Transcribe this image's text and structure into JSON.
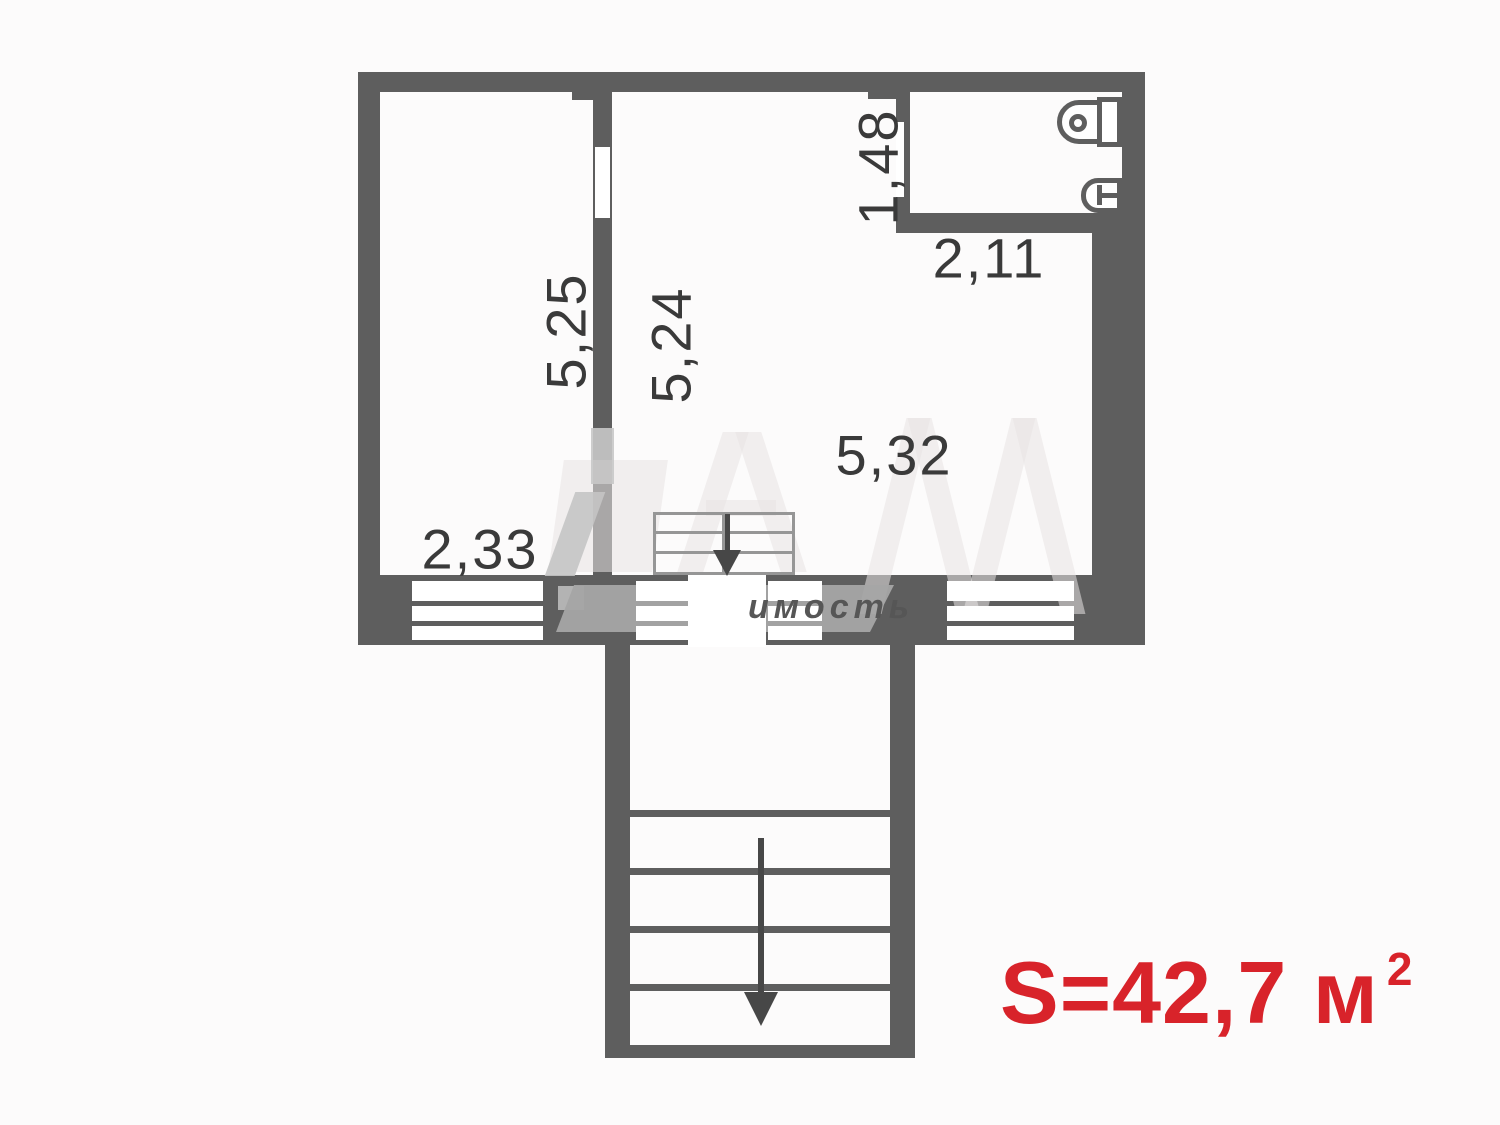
{
  "plan": {
    "dimensions": {
      "left_room_width": "2,33",
      "left_room_depth": "5,25",
      "main_room_depth": "5,24",
      "main_room_width": "5,32",
      "bathroom_width": "2,11",
      "bathroom_entry_height": "1,48"
    },
    "area_label": {
      "value": "S=42,7 м",
      "superscript": "2"
    },
    "watermark": {
      "visible_text": "имость"
    },
    "colors": {
      "wall": "#5e5e5e",
      "label": "#3a3a3a",
      "accent": "#d8232a",
      "band": "#a5a5a5"
    }
  }
}
